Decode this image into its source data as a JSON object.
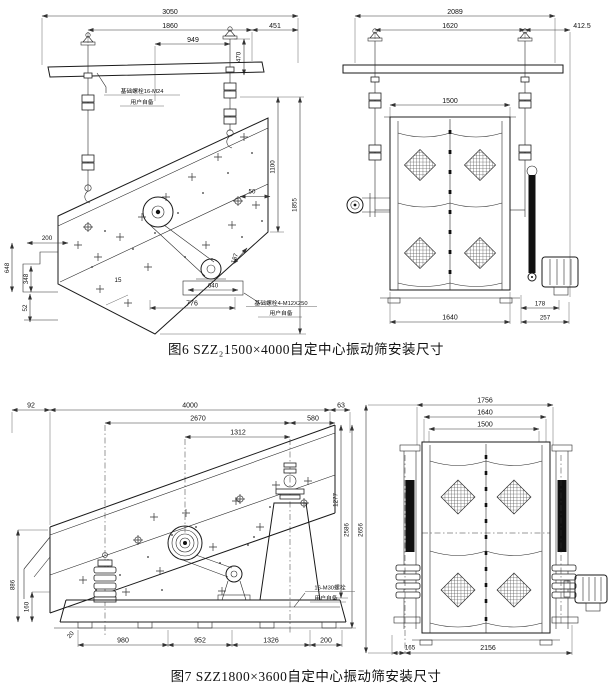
{
  "palette": {
    "background": "#ffffff",
    "line": "#1a1a1a",
    "text": "#111111"
  },
  "figure6": {
    "caption": "图6  SZZ₂1500×4000自定中心振动筛安装尺寸",
    "side": {
      "note_top_l1": "基础螺栓16-M24",
      "note_top_l2": "用户自备",
      "note_bottom_l1": "基础螺栓4-M12X250",
      "note_bottom_l2": "用户自备",
      "dims": {
        "w3050": "3050",
        "w1860": "1860",
        "w451": "451",
        "w949": "949",
        "h470": "470",
        "h1100": "1100",
        "w50": "50",
        "h1855": "1855",
        "s187": "187",
        "w200": "200",
        "h648": "648",
        "h348": "348",
        "w15": "15",
        "h52": "52",
        "w640": "640",
        "w776": "776"
      }
    },
    "end": {
      "dims": {
        "w2089": "2089",
        "w1620": "1620",
        "w412": "412.5",
        "w1500": "1500",
        "w1640": "1640",
        "h178": "178",
        "h257": "257"
      }
    }
  },
  "figure7": {
    "caption": "图7  SZZ1800×3600自定中心振动筛安装尺寸",
    "side": {
      "note_l1": "16-M30螺栓",
      "note_l2": "用户自备",
      "dims": {
        "w92": "92",
        "w4000": "4000",
        "w63": "63",
        "w2670": "2670",
        "w580": "580",
        "w1312": "1312",
        "h1277": "1277",
        "h2586": "2586",
        "h886": "886",
        "h160": "160",
        "a20": "20",
        "w980": "980",
        "w952": "952",
        "w1326": "1326",
        "w200": "200"
      }
    },
    "end": {
      "dims": {
        "w1756": "1756",
        "w1640": "1640",
        "w1500": "1500",
        "h2656": "2656",
        "w165": "165",
        "w2156": "2156"
      }
    }
  }
}
